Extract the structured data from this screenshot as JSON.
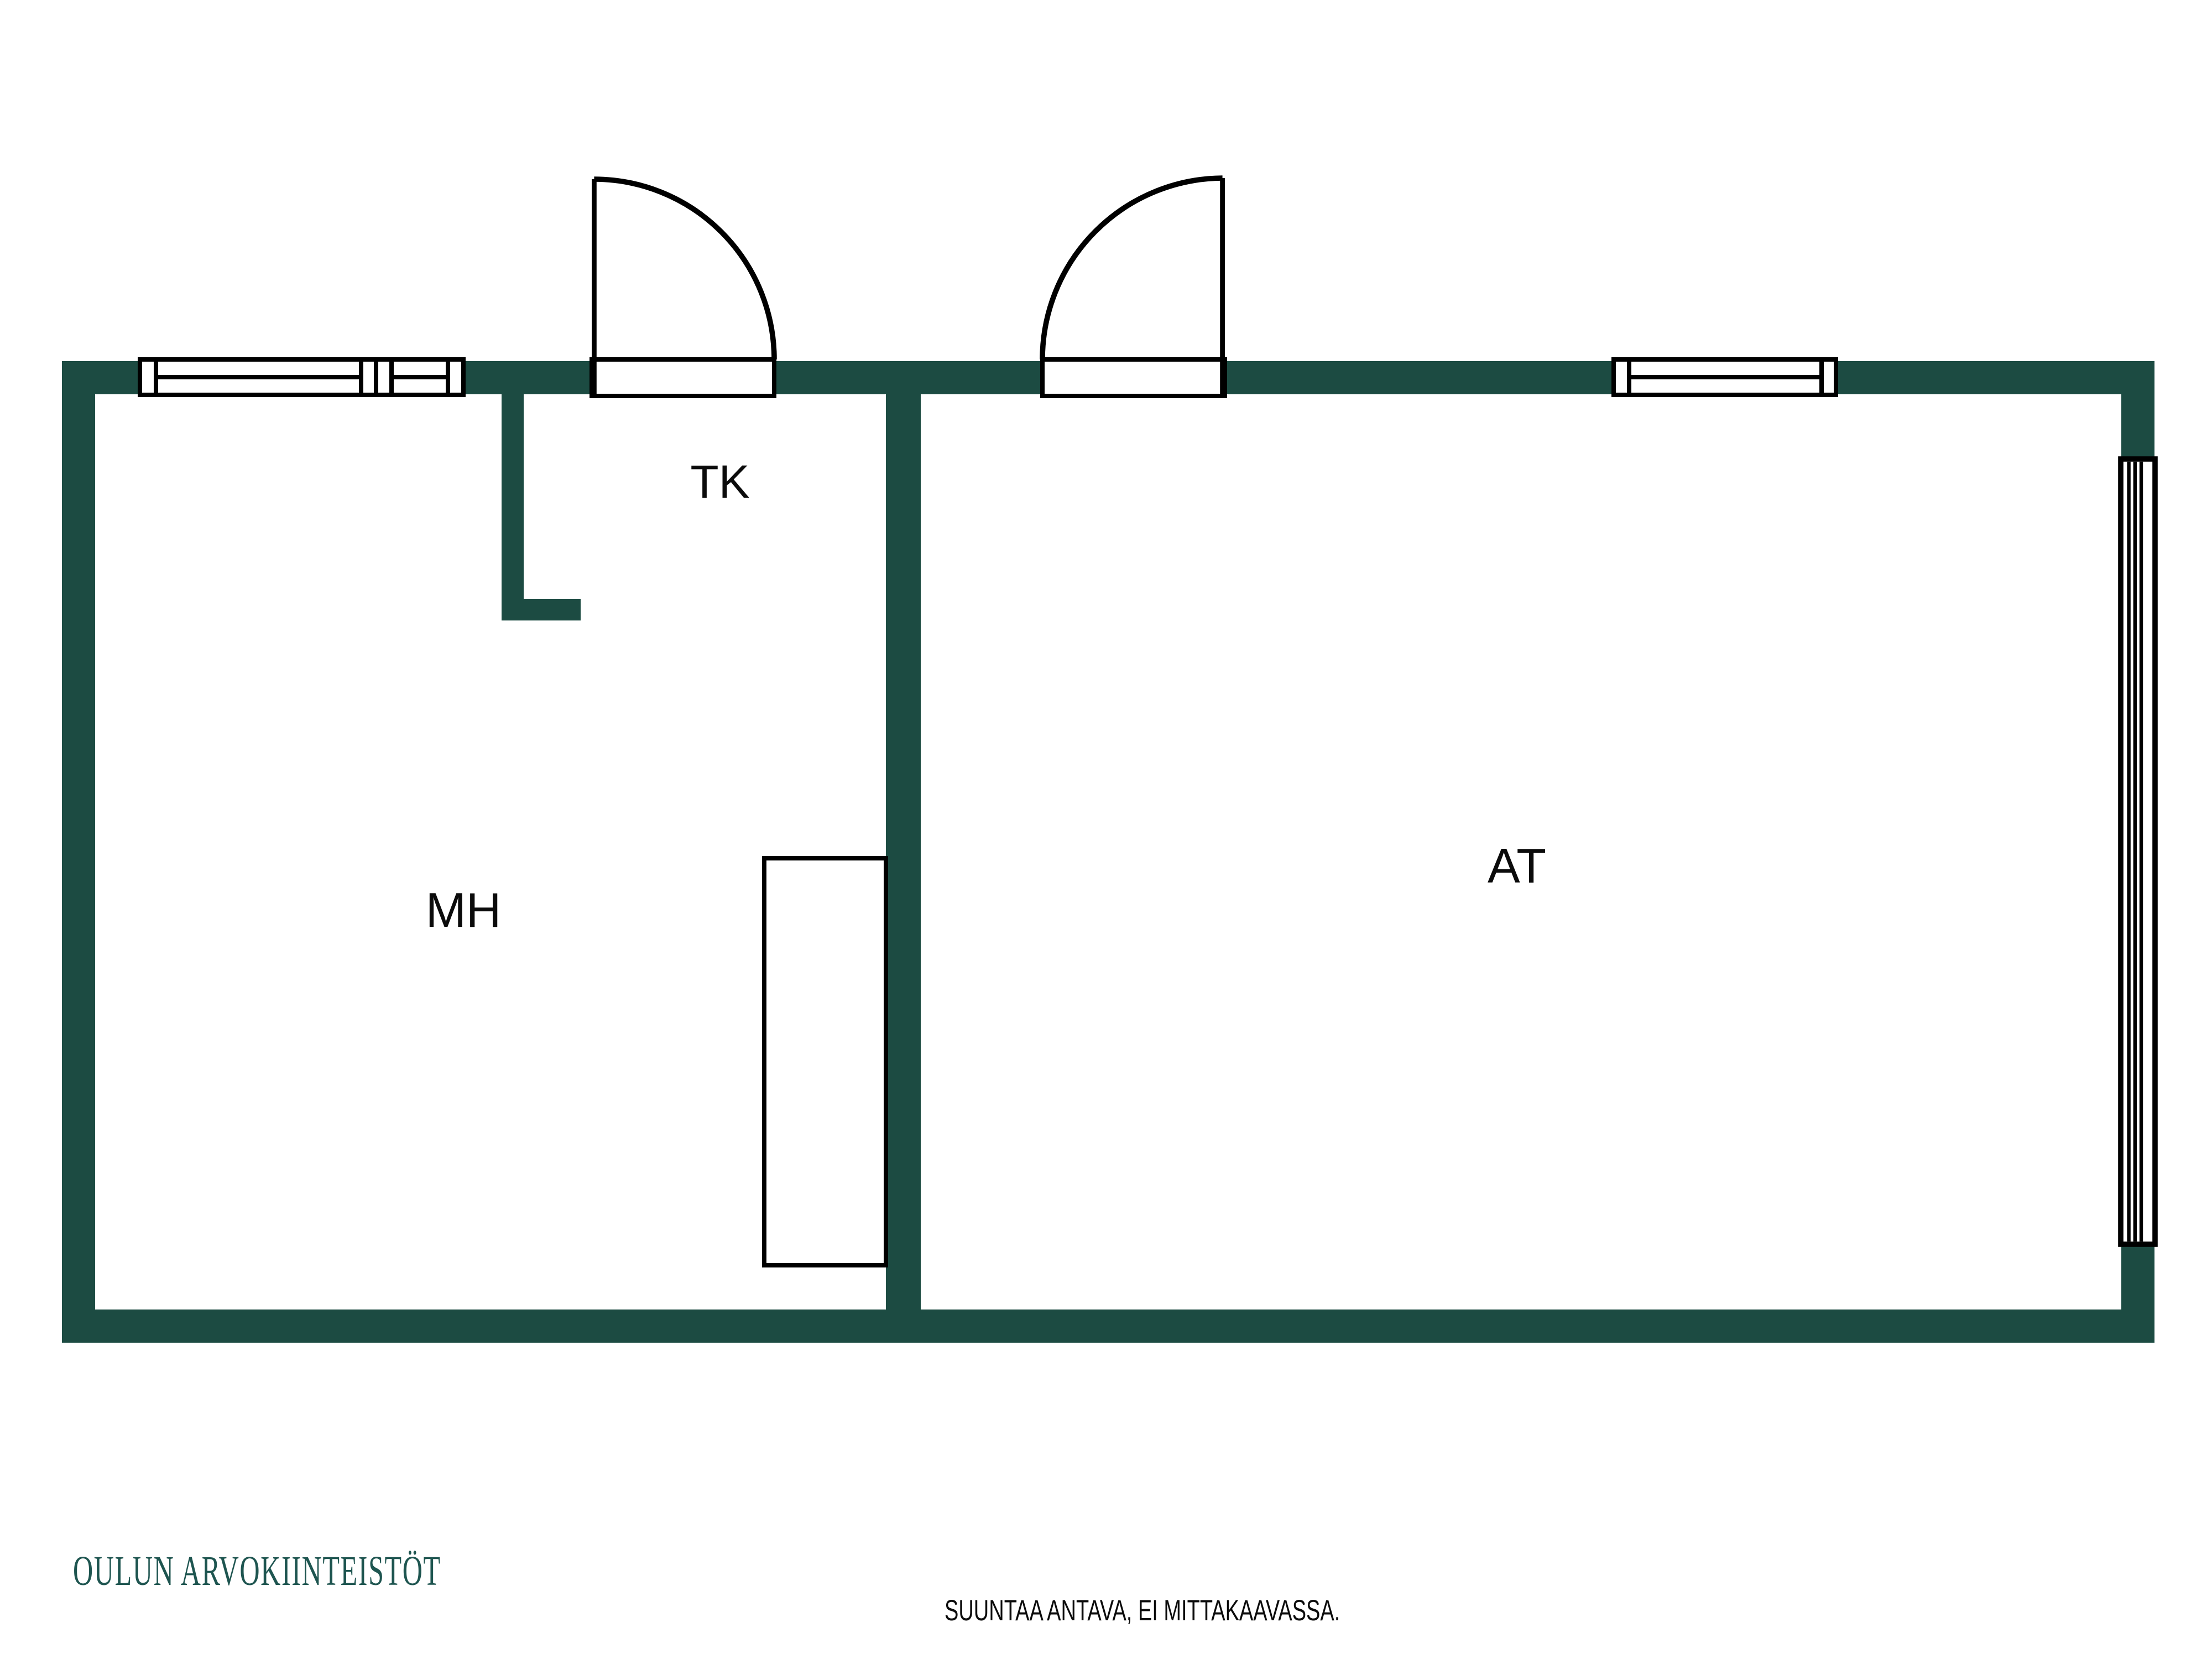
{
  "document": {
    "type": "floor-plan",
    "orientation": "landscape"
  },
  "colors": {
    "wall": "#1c4b42",
    "line": "#000000",
    "fixture_fill": "#ffffff",
    "logo": "#1e5550",
    "background": "#ffffff"
  },
  "rooms": [
    {
      "id": "mh",
      "label": "MH"
    },
    {
      "id": "tk",
      "label": "TK"
    },
    {
      "id": "at",
      "label": "AT"
    }
  ],
  "fixtures": {
    "doors": 2,
    "top_windows": 3,
    "side_windows": 1,
    "closet": 1
  },
  "footer": {
    "logo": "OULUN ARVOKIINTEISTÖT",
    "disclaimer": "SUUNTAA ANTAVA, EI MITTAKAAVASSA."
  }
}
